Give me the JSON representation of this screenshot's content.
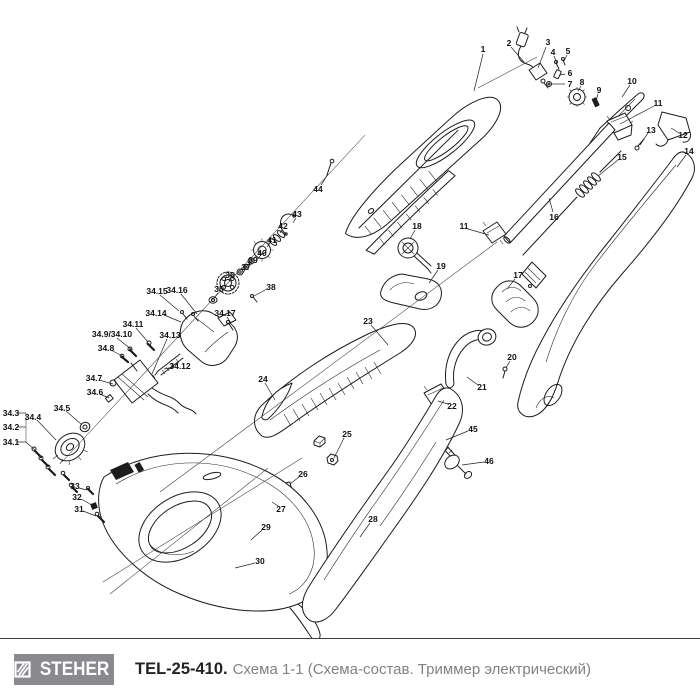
{
  "footer": {
    "brand": "STEHER",
    "model": "TEL-25-410.",
    "description": "Схема 1-1 (Схема-состав. Триммер электрический)"
  },
  "colors": {
    "ink": "#1c1c1c",
    "logo_gray": "#8a8a8e",
    "caption_gray": "#818181"
  },
  "diagram": {
    "callouts": [
      {
        "t": "1",
        "x": 483,
        "y": 49,
        "l": [
          [
            483,
            54
          ],
          [
            474,
            91
          ]
        ]
      },
      {
        "t": "2",
        "x": 509,
        "y": 43,
        "l": [
          [
            511,
            47
          ],
          [
            524,
            62
          ]
        ]
      },
      {
        "t": "3",
        "x": 548,
        "y": 42,
        "l": [
          [
            546,
            47
          ],
          [
            538,
            68
          ]
        ]
      },
      {
        "t": "4",
        "x": 553,
        "y": 52,
        "l": [
          [
            554,
            56
          ],
          [
            557,
            63
          ]
        ]
      },
      {
        "t": "5",
        "x": 568,
        "y": 51,
        "l": [
          [
            567,
            55
          ],
          [
            564,
            61
          ]
        ]
      },
      {
        "t": "6",
        "x": 570,
        "y": 73,
        "l": [
          [
            565,
            74
          ],
          [
            560,
            75
          ]
        ]
      },
      {
        "t": "7",
        "x": 570,
        "y": 84,
        "l": [
          [
            565,
            84
          ],
          [
            552,
            84
          ]
        ]
      },
      {
        "t": "8",
        "x": 582,
        "y": 82,
        "l": [
          [
            581,
            86
          ],
          [
            578,
            91
          ]
        ]
      },
      {
        "t": "9",
        "x": 599,
        "y": 90,
        "l": [
          [
            598,
            94
          ],
          [
            596,
            101
          ]
        ]
      },
      {
        "t": "10",
        "x": 632,
        "y": 81,
        "l": [
          [
            630,
            85
          ],
          [
            622,
            97
          ]
        ]
      },
      {
        "t": "11",
        "x": 658,
        "y": 103,
        "l": [
          [
            654,
            106
          ],
          [
            620,
            124
          ]
        ]
      },
      {
        "t": "12",
        "x": 683,
        "y": 135,
        "l": [
          [
            679,
            133
          ],
          [
            671,
            128
          ]
        ]
      },
      {
        "t": "13",
        "x": 651,
        "y": 130,
        "l": [
          [
            648,
            133
          ],
          [
            640,
            145
          ]
        ]
      },
      {
        "t": "14",
        "x": 689,
        "y": 151,
        "l": [
          [
            686,
            155
          ],
          [
            677,
            167
          ]
        ]
      },
      {
        "t": "15",
        "x": 622,
        "y": 157,
        "l": [
          [
            618,
            160
          ],
          [
            598,
            176
          ]
        ]
      },
      {
        "t": "16",
        "x": 554,
        "y": 217,
        "l": [
          [
            553,
            212
          ],
          [
            549,
            198
          ]
        ]
      },
      {
        "t": "17",
        "x": 518,
        "y": 275,
        "l": [
          [
            515,
            279
          ],
          [
            507,
            289
          ]
        ]
      },
      {
        "t": "44",
        "x": 318,
        "y": 189,
        "l": [
          [
            321,
            185
          ],
          [
            328,
            174
          ]
        ]
      },
      {
        "t": "11",
        "x": 464,
        "y": 226,
        "l": [
          [
            468,
            229
          ],
          [
            489,
            235
          ]
        ]
      },
      {
        "t": "18",
        "x": 417,
        "y": 226,
        "l": [
          [
            415,
            230
          ],
          [
            410,
            239
          ]
        ]
      },
      {
        "t": "19",
        "x": 441,
        "y": 266,
        "l": [
          [
            438,
            270
          ],
          [
            429,
            283
          ]
        ]
      },
      {
        "t": "20",
        "x": 512,
        "y": 357,
        "l": [
          [
            510,
            361
          ],
          [
            506,
            368
          ]
        ]
      },
      {
        "t": "21",
        "x": 482,
        "y": 387,
        "l": [
          [
            478,
            385
          ],
          [
            467,
            377
          ]
        ]
      },
      {
        "t": "22",
        "x": 452,
        "y": 406,
        "l": [
          [
            448,
            404
          ],
          [
            438,
            401
          ]
        ]
      },
      {
        "t": "45",
        "x": 473,
        "y": 429,
        "l": [
          [
            468,
            431
          ],
          [
            446,
            440
          ]
        ]
      },
      {
        "t": "46",
        "x": 489,
        "y": 461,
        "l": [
          [
            484,
            462
          ],
          [
            462,
            465
          ]
        ]
      },
      {
        "t": "23",
        "x": 368,
        "y": 321,
        "l": [
          [
            371,
            325
          ],
          [
            388,
            345
          ]
        ]
      },
      {
        "t": "24",
        "x": 263,
        "y": 379,
        "l": [
          [
            265,
            383
          ],
          [
            275,
            400
          ]
        ]
      },
      {
        "t": "25",
        "x": 347,
        "y": 434,
        "l": [
          [
            344,
            438
          ],
          [
            334,
            458
          ]
        ]
      },
      {
        "t": "26",
        "x": 303,
        "y": 474,
        "l": [
          [
            299,
            477
          ],
          [
            290,
            484
          ]
        ]
      },
      {
        "t": "27",
        "x": 281,
        "y": 509,
        "l": [
          [
            278,
            506
          ],
          [
            272,
            502
          ]
        ]
      },
      {
        "t": "28",
        "x": 373,
        "y": 519,
        "l": [
          [
            370,
            523
          ],
          [
            360,
            537
          ]
        ]
      },
      {
        "t": "29",
        "x": 266,
        "y": 527,
        "l": [
          [
            262,
            530
          ],
          [
            251,
            540
          ]
        ]
      },
      {
        "t": "30",
        "x": 260,
        "y": 561,
        "l": [
          [
            255,
            563
          ],
          [
            235,
            568
          ]
        ]
      },
      {
        "t": "31",
        "x": 79,
        "y": 509,
        "l": [
          [
            83,
            511
          ],
          [
            96,
            516
          ]
        ]
      },
      {
        "t": "32",
        "x": 77,
        "y": 497,
        "l": [
          [
            81,
            499
          ],
          [
            92,
            505
          ]
        ]
      },
      {
        "t": "33",
        "x": 75,
        "y": 486,
        "l": [
          [
            79,
            488
          ],
          [
            87,
            490
          ]
        ]
      },
      {
        "t": "35",
        "x": 219,
        "y": 289,
        "l": [
          [
            218,
            293
          ],
          [
            214,
            298
          ]
        ]
      },
      {
        "t": "36",
        "x": 230,
        "y": 275,
        "l": [
          [
            230,
            278
          ],
          [
            229,
            281
          ]
        ]
      },
      {
        "t": "37",
        "x": 246,
        "y": 267,
        "l": [
          [
            245,
            270
          ],
          [
            242,
            274
          ]
        ]
      },
      {
        "t": "38",
        "x": 271,
        "y": 287,
        "l": [
          [
            267,
            289
          ],
          [
            254,
            296
          ]
        ]
      },
      {
        "t": "39",
        "x": 253,
        "y": 260,
        "l": [
          [
            252,
            263
          ],
          [
            248,
            267
          ]
        ]
      },
      {
        "t": "40",
        "x": 262,
        "y": 253,
        "l": [
          [
            260,
            256
          ],
          [
            256,
            261
          ]
        ]
      },
      {
        "t": "41",
        "x": 272,
        "y": 240,
        "l": [
          [
            270,
            243
          ],
          [
            267,
            247
          ]
        ]
      },
      {
        "t": "42",
        "x": 283,
        "y": 226,
        "l": [
          [
            282,
            230
          ],
          [
            280,
            233
          ]
        ]
      },
      {
        "t": "43",
        "x": 297,
        "y": 214,
        "l": [
          [
            296,
            218
          ],
          [
            293,
            223
          ]
        ]
      },
      {
        "t": "34.16",
        "x": 177,
        "y": 290,
        "l": [
          [
            181,
            294
          ],
          [
            197,
            314
          ]
        ]
      },
      {
        "t": "34.15",
        "x": 157,
        "y": 291,
        "l": [
          [
            160,
            295
          ],
          [
            179,
            311
          ]
        ]
      },
      {
        "t": "34.14",
        "x": 156,
        "y": 313,
        "l": [
          [
            164,
            315
          ],
          [
            181,
            322
          ]
        ]
      },
      {
        "t": "34.17",
        "x": 225,
        "y": 313,
        "l": [
          [
            227,
            317
          ],
          [
            231,
            323
          ]
        ]
      },
      {
        "t": "34.13",
        "x": 170,
        "y": 335,
        "l": [
          [
            167,
            339
          ],
          [
            152,
            374
          ]
        ]
      },
      {
        "t": "34.12",
        "x": 180,
        "y": 366,
        "l": [
          [
            174,
            367
          ],
          [
            164,
            369
          ]
        ]
      },
      {
        "t": "34.11",
        "x": 133,
        "y": 324,
        "l": [
          [
            136,
            328
          ],
          [
            148,
            342
          ]
        ]
      },
      {
        "t": "34.9/34.10",
        "x": 112,
        "y": 334,
        "l": [
          [
            117,
            338
          ],
          [
            132,
            350
          ]
        ]
      },
      {
        "t": "34.8",
        "x": 106,
        "y": 348,
        "l": [
          [
            111,
            350
          ],
          [
            124,
            357
          ]
        ]
      },
      {
        "t": "34.7",
        "x": 94,
        "y": 378,
        "l": [
          [
            99,
            380
          ],
          [
            113,
            384
          ]
        ]
      },
      {
        "t": "34.6",
        "x": 95,
        "y": 392,
        "l": [
          [
            100,
            394
          ],
          [
            109,
            398
          ]
        ]
      },
      {
        "t": "34.5",
        "x": 62,
        "y": 408,
        "l": [
          [
            66,
            411
          ],
          [
            81,
            424
          ]
        ]
      },
      {
        "t": "34.4",
        "x": 33,
        "y": 417,
        "l": [
          [
            37,
            420
          ],
          [
            56,
            440
          ]
        ]
      },
      {
        "t": "34.3",
        "x": 11,
        "y": 413,
        "l": [
          [
            17,
            413
          ],
          [
            26,
            413
          ]
        ]
      },
      {
        "t": "34.2",
        "x": 11,
        "y": 427,
        "l": [
          [
            17,
            427
          ],
          [
            26,
            427
          ]
        ]
      },
      {
        "t": "34.1",
        "x": 11,
        "y": 442,
        "l": [
          [
            17,
            442
          ],
          [
            26,
            442
          ],
          [
            37,
            452
          ]
        ]
      }
    ],
    "extra_lines": [
      [
        [
          26,
          413
        ],
        [
          26,
          442
        ]
      ],
      [
        [
          537,
          57
        ],
        [
          478,
          88
        ]
      ],
      [
        [
          365,
          135
        ],
        [
          62,
          462
        ]
      ],
      [
        [
          497,
          242
        ],
        [
          160,
          492
        ]
      ],
      [
        [
          302,
          458
        ],
        [
          103,
          582
        ]
      ],
      [
        [
          268,
          468
        ],
        [
          110,
          594
        ]
      ]
    ]
  }
}
